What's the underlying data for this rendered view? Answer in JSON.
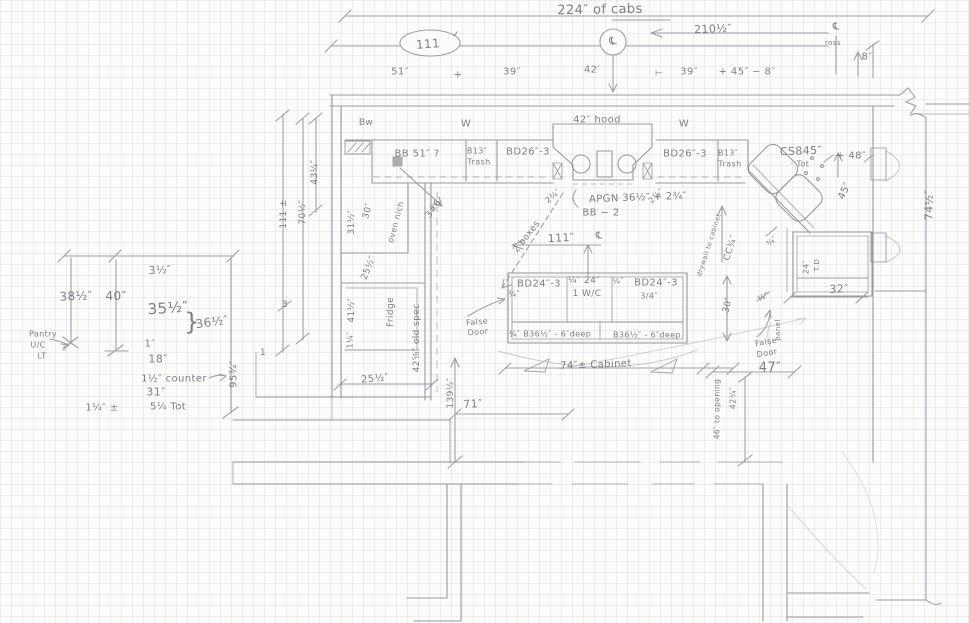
{
  "document": {
    "kind": "hand-drawn pencil kitchen cabinet floor plan on graph paper",
    "units": "inches"
  },
  "colors": {
    "paper": "#fcfcfa",
    "grid_line": "#aebfd2",
    "pencil": "#8a8a90",
    "text_pencil": "#6e6e77"
  },
  "annotations": [
    {
      "id": "cabs-total",
      "text": "224″ of cabs",
      "x": 600,
      "y": 10,
      "s": 13,
      "rot": -1
    },
    {
      "id": "dim-111-top",
      "text": "111",
      "x": 428,
      "y": 44,
      "s": 12,
      "rot": -4
    },
    {
      "id": "check-111",
      "text": "✓",
      "x": 456,
      "y": 35,
      "s": 9,
      "rot": 0
    },
    {
      "id": "cl-top",
      "text": "℄",
      "x": 613,
      "y": 41,
      "s": 11,
      "rot": -8
    },
    {
      "id": "dim-210half",
      "text": "210½″",
      "x": 713,
      "y": 29,
      "s": 11,
      "rot": -2
    },
    {
      "id": "cl-right",
      "text": "℄",
      "x": 836,
      "y": 27,
      "s": 10,
      "rot": 0
    },
    {
      "id": "ross-note",
      "text": "ross",
      "x": 833,
      "y": 43,
      "s": 7,
      "rot": 0
    },
    {
      "id": "dim-8",
      "text": "8″",
      "x": 867,
      "y": 57,
      "s": 10,
      "rot": 0
    },
    {
      "id": "dim-51",
      "text": "51″",
      "x": 400,
      "y": 72,
      "s": 10,
      "rot": 0
    },
    {
      "id": "plus-a",
      "text": "+",
      "x": 458,
      "y": 75,
      "s": 10,
      "rot": 0
    },
    {
      "id": "dim-39a",
      "text": "39″",
      "x": 512,
      "y": 72,
      "s": 10,
      "rot": 0
    },
    {
      "id": "dim-42",
      "text": "42′",
      "x": 592,
      "y": 70,
      "s": 10,
      "rot": 0
    },
    {
      "id": "sep-tick",
      "text": "⊢",
      "x": 659,
      "y": 74,
      "s": 9,
      "rot": 0
    },
    {
      "id": "dim-39b",
      "text": "39″",
      "x": 689,
      "y": 72,
      "s": 10,
      "rot": 0
    },
    {
      "id": "dim-45-8",
      "text": "+ 45″ − 8″",
      "x": 747,
      "y": 72,
      "s": 10,
      "rot": 0
    },
    {
      "id": "window-bw",
      "text": "Bw",
      "x": 366,
      "y": 123,
      "s": 9,
      "rot": 0
    },
    {
      "id": "window-w-left",
      "text": "W",
      "x": 466,
      "y": 124,
      "s": 10,
      "rot": 0
    },
    {
      "id": "hood-42",
      "text": "42″ hood",
      "x": 597,
      "y": 120,
      "s": 10,
      "rot": 0
    },
    {
      "id": "window-w-right",
      "text": "W",
      "x": 684,
      "y": 124,
      "s": 10,
      "rot": 0
    },
    {
      "id": "cab-bb51",
      "text": "BB 51″ ?",
      "x": 417,
      "y": 154,
      "s": 10,
      "rot": 0
    },
    {
      "id": "cab-b13-l",
      "text": "B13″",
      "x": 477,
      "y": 151,
      "s": 8,
      "rot": 0
    },
    {
      "id": "cab-b13-l-trash",
      "text": "Trash",
      "x": 479,
      "y": 162,
      "s": 8,
      "rot": 0
    },
    {
      "id": "cab-bd26-l",
      "text": "BD26″-3",
      "x": 528,
      "y": 152,
      "s": 10,
      "rot": 0
    },
    {
      "id": "cab-bd26-r",
      "text": "BD26″-3",
      "x": 685,
      "y": 154,
      "s": 10,
      "rot": 0
    },
    {
      "id": "cab-b13-r",
      "text": "B13″",
      "x": 728,
      "y": 153,
      "s": 8,
      "rot": 0
    },
    {
      "id": "cab-b13-r-trash",
      "text": "Trash",
      "x": 730,
      "y": 164,
      "s": 8,
      "rot": 0
    },
    {
      "id": "cab-cs845",
      "text": "CS845″",
      "x": 801,
      "y": 151,
      "s": 11,
      "rot": -2
    },
    {
      "id": "cs845-tot",
      "text": "· Tot",
      "x": 800,
      "y": 164,
      "s": 8,
      "rot": 0
    },
    {
      "id": "dim-48",
      "text": "+ 48″",
      "x": 851,
      "y": 156,
      "s": 10,
      "rot": 0
    },
    {
      "id": "dim-45-up",
      "text": "45″",
      "x": 845,
      "y": 191,
      "s": 10,
      "rot": -65
    },
    {
      "id": "dim-74half",
      "text": "74½″",
      "x": 929,
      "y": 205,
      "s": 11,
      "rot": -90
    },
    {
      "id": "dim-43half",
      "text": "43½″",
      "x": 315,
      "y": 172,
      "s": 9,
      "rot": -90
    },
    {
      "id": "dim-111-left",
      "text": "111 ±",
      "x": 284,
      "y": 214,
      "s": 9,
      "rot": -90
    },
    {
      "id": "dim-70half",
      "text": "70½″",
      "x": 303,
      "y": 212,
      "s": 9,
      "rot": -90
    },
    {
      "id": "num-3",
      "text": "3",
      "x": 285,
      "y": 305,
      "s": 9,
      "rot": 0
    },
    {
      "id": "dim-31half-col",
      "text": "31½″",
      "x": 352,
      "y": 222,
      "s": 9,
      "rot": -90
    },
    {
      "id": "dim-30-col",
      "text": "30″",
      "x": 368,
      "y": 211,
      "s": 9,
      "rot": -75
    },
    {
      "id": "oven-niche",
      "text": "oven nich",
      "x": 396,
      "y": 222,
      "s": 8,
      "rot": -75
    },
    {
      "id": "note-3-6",
      "text": "3#6",
      "x": 434,
      "y": 209,
      "s": 9,
      "rot": -55
    },
    {
      "id": "dim-25half-col",
      "text": "25½″",
      "x": 369,
      "y": 268,
      "s": 9,
      "rot": -68
    },
    {
      "id": "dim-41half",
      "text": "41½″",
      "x": 352,
      "y": 310,
      "s": 9,
      "rot": -90
    },
    {
      "id": "dim-1quarter-col",
      "text": "1¼″",
      "x": 350,
      "y": 340,
      "s": 8,
      "rot": -90
    },
    {
      "id": "fridge-label",
      "text": "Fridge",
      "x": 391,
      "y": 312,
      "s": 9,
      "rot": -90
    },
    {
      "id": "old-spec",
      "text": "42⅝″ old spec",
      "x": 417,
      "y": 338,
      "s": 9,
      "rot": -90
    },
    {
      "id": "dim-3half",
      "text": "3½″",
      "x": 160,
      "y": 270,
      "s": 11,
      "rot": -3
    },
    {
      "id": "dim-38half",
      "text": "38½″",
      "x": 76,
      "y": 296,
      "s": 12,
      "rot": -2
    },
    {
      "id": "dim-40",
      "text": "40″",
      "x": 116,
      "y": 296,
      "s": 12,
      "rot": 0
    },
    {
      "id": "dim-35half",
      "text": "35½″",
      "x": 168,
      "y": 308,
      "s": 15,
      "rot": -4
    },
    {
      "id": "dim-36half",
      "text": "36½″",
      "x": 212,
      "y": 322,
      "s": 12,
      "rot": -8
    },
    {
      "id": "brace-36",
      "text": "}",
      "x": 192,
      "y": 322,
      "s": 24,
      "rot": 0
    },
    {
      "id": "pantry-1",
      "text": "Pantry",
      "x": 43,
      "y": 334,
      "s": 8,
      "rot": 0
    },
    {
      "id": "pantry-2",
      "text": "U/C",
      "x": 38,
      "y": 345,
      "s": 8,
      "rot": 0
    },
    {
      "id": "pantry-3",
      "text": "LT",
      "x": 42,
      "y": 356,
      "s": 8,
      "rot": 0
    },
    {
      "id": "dim-1in",
      "text": "1″",
      "x": 150,
      "y": 344,
      "s": 10,
      "rot": 0
    },
    {
      "id": "dim-18",
      "text": "18″",
      "x": 158,
      "y": 359,
      "s": 11,
      "rot": 0
    },
    {
      "id": "note-counter",
      "text": "1½″ counter",
      "x": 174,
      "y": 379,
      "s": 10,
      "rot": 0
    },
    {
      "id": "dim-31",
      "text": "31″",
      "x": 156,
      "y": 392,
      "s": 11,
      "rot": 0
    },
    {
      "id": "dim-1quarter-pm",
      "text": "1¼″ ±",
      "x": 102,
      "y": 408,
      "s": 10,
      "rot": 0
    },
    {
      "id": "dim-5quarter-tot",
      "text": "5¼ Tot",
      "x": 168,
      "y": 407,
      "s": 10,
      "rot": 0
    },
    {
      "id": "dim-95threequarter",
      "text": "95¾″",
      "x": 234,
      "y": 374,
      "s": 10,
      "rot": -90
    },
    {
      "id": "num-1",
      "text": "1",
      "x": 263,
      "y": 353,
      "s": 9,
      "rot": 0
    },
    {
      "id": "note-2boxes",
      "text": "2 boxes",
      "x": 527,
      "y": 237,
      "s": 9,
      "rot": -52
    },
    {
      "id": "dim-234-l",
      "text": "2¾″",
      "x": 553,
      "y": 196,
      "s": 8,
      "rot": -40
    },
    {
      "id": "dim-234-r",
      "text": "2¾″",
      "x": 656,
      "y": 196,
      "s": 8,
      "rot": -45
    },
    {
      "id": "apron-note",
      "text": "APGN 36½″ + 2¾″",
      "x": 638,
      "y": 198,
      "s": 10,
      "rot": -2
    },
    {
      "id": "bb2-note",
      "text": "BB − 2",
      "x": 601,
      "y": 213,
      "s": 10,
      "rot": 0
    },
    {
      "id": "dim-111-center",
      "text": "111″",
      "x": 561,
      "y": 238,
      "s": 11,
      "rot": -3
    },
    {
      "id": "cl-center",
      "text": "℄",
      "x": 599,
      "y": 236,
      "s": 10,
      "rot": 0
    },
    {
      "id": "cc34-note",
      "text": "CC¾″",
      "x": 731,
      "y": 248,
      "s": 9,
      "rot": -72
    },
    {
      "id": "drywall-note",
      "text": "drywall to cabinet",
      "x": 709,
      "y": 245,
      "s": 6.5,
      "rot": -72
    },
    {
      "id": "dim-34-corner",
      "text": "¾″",
      "x": 772,
      "y": 241,
      "s": 8,
      "rot": -45
    },
    {
      "id": "dim-30-right",
      "text": "30″",
      "x": 728,
      "y": 305,
      "s": 9,
      "rot": -78
    },
    {
      "id": "dim-34-right",
      "text": "¾″",
      "x": 763,
      "y": 297,
      "s": 8,
      "rot": -25
    },
    {
      "id": "panel-note",
      "text": "panel",
      "x": 778,
      "y": 330,
      "s": 7,
      "rot": -90
    },
    {
      "id": "dim-24-box",
      "text": "24″",
      "x": 806,
      "y": 267,
      "s": 8,
      "rot": -90
    },
    {
      "id": "td-note",
      "text": "T.D",
      "x": 817,
      "y": 265,
      "s": 7,
      "rot": -90
    },
    {
      "id": "dim-32",
      "text": "32″",
      "x": 839,
      "y": 289,
      "s": 11,
      "rot": -2
    },
    {
      "id": "island-bd24-l",
      "text": "BD24″-3",
      "x": 539,
      "y": 284,
      "s": 10,
      "rot": 0
    },
    {
      "id": "island-34-l",
      "text": "¾″",
      "x": 514,
      "y": 294,
      "s": 8,
      "rot": 0
    },
    {
      "id": "island-quarter24",
      "text": "¼″ 24″",
      "x": 584,
      "y": 281,
      "s": 9,
      "rot": 0
    },
    {
      "id": "island-1wc",
      "text": "1 W/C",
      "x": 587,
      "y": 294,
      "s": 9,
      "rot": 0
    },
    {
      "id": "island-quarter",
      "text": "¼″",
      "x": 618,
      "y": 281,
      "s": 8,
      "rot": 0
    },
    {
      "id": "island-bd24-r",
      "text": "BD24″-3",
      "x": 656,
      "y": 283,
      "s": 10,
      "rot": 0
    },
    {
      "id": "island-34-r",
      "text": "3/4″",
      "x": 649,
      "y": 296,
      "s": 8,
      "rot": 0
    },
    {
      "id": "island-b36-l",
      "text": "¾″ B36½″ - 6″deep",
      "x": 550,
      "y": 334,
      "s": 8,
      "rot": 0
    },
    {
      "id": "island-b36-r",
      "text": "B36½″ - 6″deep",
      "x": 647,
      "y": 335,
      "s": 8,
      "rot": 0
    },
    {
      "id": "dim-74-cabinet",
      "text": "74″± Cabinet",
      "x": 596,
      "y": 365,
      "s": 10,
      "rot": -2
    },
    {
      "id": "false-door-l1",
      "text": "False",
      "x": 477,
      "y": 322,
      "s": 8,
      "rot": -5
    },
    {
      "id": "false-door-l2",
      "text": "Door",
      "x": 478,
      "y": 332,
      "s": 8,
      "rot": -5
    },
    {
      "id": "false-door-r1",
      "text": "False",
      "x": 766,
      "y": 342,
      "s": 8,
      "rot": -10
    },
    {
      "id": "false-door-r2",
      "text": "Door",
      "x": 767,
      "y": 353,
      "s": 8,
      "rot": -10
    },
    {
      "id": "dim-47",
      "text": "47″",
      "x": 770,
      "y": 368,
      "s": 13,
      "rot": 0
    },
    {
      "id": "dim-139half",
      "text": "139½″",
      "x": 451,
      "y": 393,
      "s": 9,
      "rot": -90
    },
    {
      "id": "dim-71",
      "text": "71″",
      "x": 473,
      "y": 404,
      "s": 11,
      "rot": -3
    },
    {
      "id": "dim-25half-btm",
      "text": "25½″",
      "x": 375,
      "y": 379,
      "s": 10,
      "rot": -5
    },
    {
      "id": "dim-4234-opening",
      "text": "42¾″",
      "x": 733,
      "y": 398,
      "s": 8,
      "rot": -90
    },
    {
      "id": "note-to-opening",
      "text": "46″ to opening",
      "x": 717,
      "y": 409,
      "s": 7.5,
      "rot": -90
    }
  ]
}
